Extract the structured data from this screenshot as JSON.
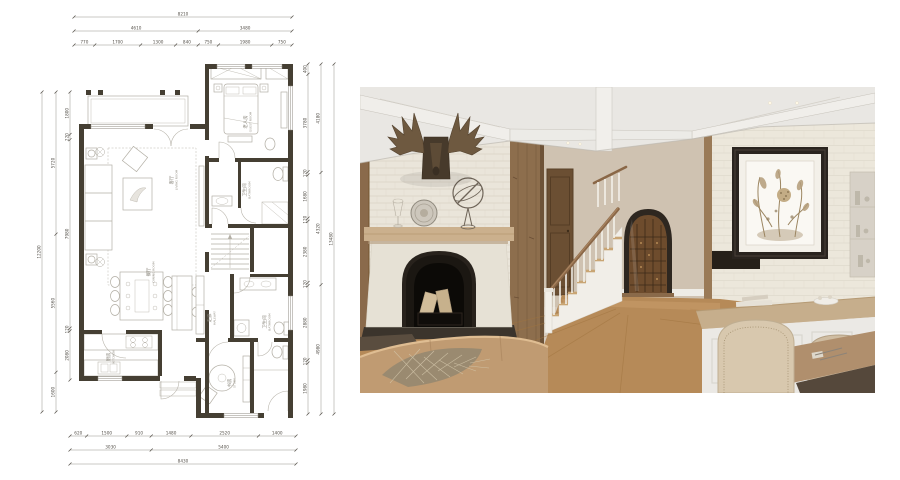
{
  "page": {
    "background": "#ffffff",
    "kind": "interior-design-presentation"
  },
  "floor_plan": {
    "dimensions": {
      "top_rows": [
        [
          "8210"
        ],
        [
          "4610",
          "3480"
        ],
        [
          "770",
          "1700",
          "1300",
          "840",
          "750",
          "1980",
          "750"
        ]
      ],
      "bottom_rows": [
        [
          "620",
          "1500",
          "910",
          "1480",
          "2520",
          "1400"
        ],
        [
          "3030",
          "5400"
        ],
        [
          "8430"
        ]
      ],
      "left_columns": [
        [
          "12200"
        ],
        [
          "5720",
          "5560",
          "1600"
        ],
        [
          "1800",
          "220",
          "7980",
          "120",
          "2080"
        ]
      ],
      "right_columns": [
        [
          "400",
          "3780",
          "120",
          "1680",
          "120",
          "2380",
          "120",
          "2880",
          "120",
          "1980"
        ],
        [
          "4180",
          "4320",
          "4980"
        ],
        [
          "13480"
        ]
      ]
    },
    "rooms": [
      {
        "zh": "客厅",
        "en": "LIVING ROOM"
      },
      {
        "zh": "餐厅",
        "en": "DINING ROOM"
      },
      {
        "zh": "厨房",
        "en": "KITCHEN"
      },
      {
        "zh": "老人房",
        "en": "GUEST ROOM"
      },
      {
        "zh": "卫生间",
        "en": "BATHROOM"
      },
      {
        "zh": "走廊",
        "en": "HALLWAY"
      },
      {
        "zh": "卫生间",
        "en": "BATHROOM"
      },
      {
        "zh": "书房",
        "en": "STUDY"
      }
    ],
    "colors": {
      "wall": "#453f33",
      "furniture_line": "#b3afa5",
      "dim_line": "#8b877d",
      "dim_text": "#55514a",
      "room_text": "#8a867c"
    }
  },
  "photo": {
    "elements": [
      "coffered-ceiling",
      "white-brick-wall",
      "moose-antler-mount",
      "armillary-sphere",
      "decor-plate",
      "glass-goblet",
      "stone-fireplace",
      "firewood-logs",
      "wood-plank-column",
      "paneled-wood-door",
      "staircase",
      "wood-handrail",
      "wine-cellar-arch-door",
      "botanical-artwork",
      "wall-shelf",
      "kitchen-island",
      "upholstered-chairs",
      "dining-table",
      "leather-sofa",
      "metallic-throw",
      "plank-wood-floor"
    ],
    "palette": {
      "ceiling": "#e9e7e3",
      "brick": "#eae5da",
      "wood": "#8d6e4d",
      "floor": "#b68a58",
      "fireplace_black": "#1b1712",
      "stair_tread": "#c9a574",
      "sofa": "#c09b72",
      "art_frame": "#2a241f",
      "wine_arch": "#2e2720"
    }
  }
}
